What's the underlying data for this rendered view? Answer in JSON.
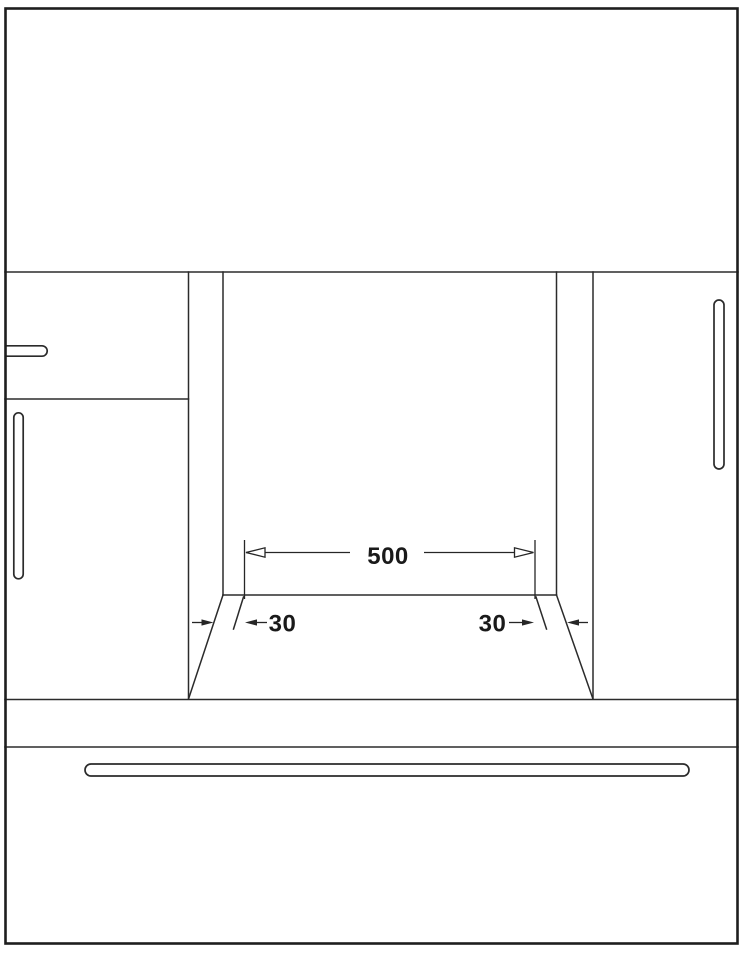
{
  "diagram": {
    "kind": "appliance-niche-installation-front-view",
    "dimension_labels": {
      "niche_width": "500",
      "wall_thickness_left": "30",
      "wall_thickness_right": "30"
    },
    "colors": {
      "background": "#ffffff",
      "frame": "#1e1e1e",
      "line": "#2b2b2b",
      "dimension_line": "#262626",
      "label_text": "#1a1a1a"
    }
  }
}
